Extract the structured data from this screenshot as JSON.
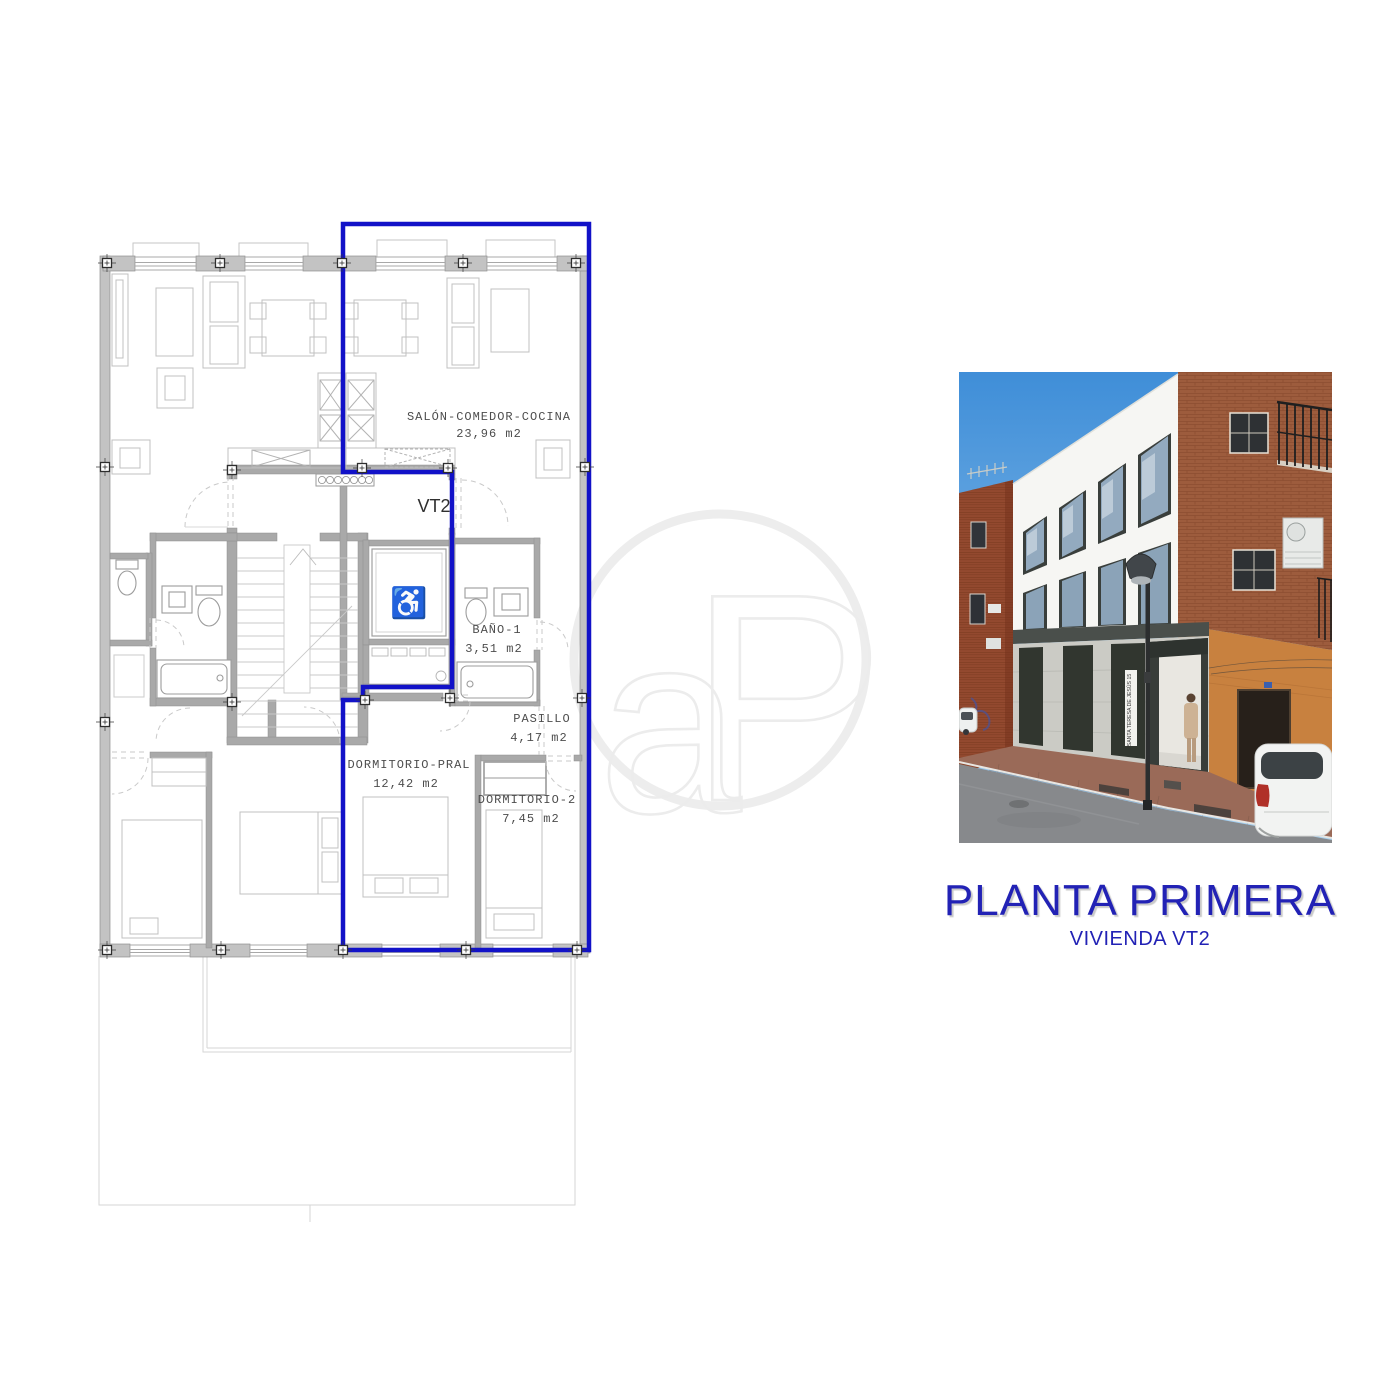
{
  "floor_plan": {
    "unit_label": "VT2",
    "outline_color": "#1212c8",
    "rooms": [
      {
        "name": "SALÓN-COMEDOR-COCINA",
        "area": "23,96 m2"
      },
      {
        "name": "BAÑO-1",
        "area": "3,51 m2"
      },
      {
        "name": "PASILLO",
        "area": "4,17 m2"
      },
      {
        "name": "DORMITORIO-PRAL",
        "area": "12,42 m2"
      },
      {
        "name": "DORMITORIO-2",
        "area": "7,45 m2"
      }
    ],
    "watermark": "aP"
  },
  "photo": {
    "street_sign": "SANTA TERESA DE JESÚS 15",
    "sky_color": "#4a97dd",
    "facade_color": "#f6f6f3",
    "brick_color": "#9d5c3d",
    "orange_color": "#c8813f"
  },
  "caption": {
    "title": "PLANTA PRIMERA",
    "subtitle": "VIVIENDA VT2",
    "color": "#2222b5"
  }
}
